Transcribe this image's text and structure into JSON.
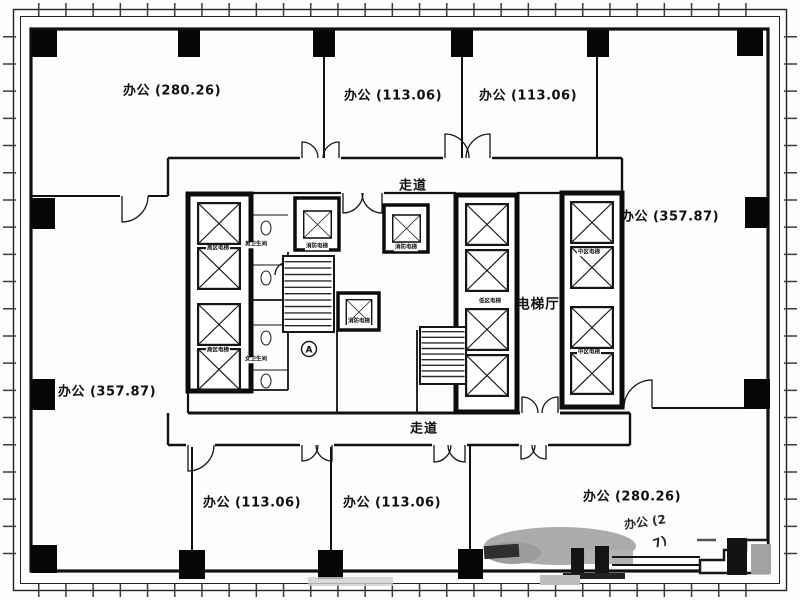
{
  "drawing": {
    "type": "architectural-floor-plan",
    "line_color": "#161616",
    "watermark_gray": "#a9a9a9"
  },
  "rooms": [
    {
      "id": "office-top-left",
      "text": "办公 (280.26)"
    },
    {
      "id": "office-top-mid-left",
      "text": "办公 (113.06)"
    },
    {
      "id": "office-top-mid-right",
      "text": "办公 (113.06)"
    },
    {
      "id": "office-right",
      "text": "办公 (357.87)"
    },
    {
      "id": "office-left",
      "text": "办公 (357.87)"
    },
    {
      "id": "office-bottom-left",
      "text": "办公 (113.06)"
    },
    {
      "id": "office-bottom-mid",
      "text": "办公 (113.06)"
    },
    {
      "id": "office-bottom-right",
      "text": "办公 (280.26)"
    },
    {
      "id": "office-partial-1",
      "text": "办公 (2"
    },
    {
      "id": "office-partial-2",
      "text": "7)"
    }
  ],
  "circulation": {
    "corridor_top": "走道",
    "corridor_bottom": "走道",
    "elevator_hall": "电梯厅"
  },
  "elevators": {
    "high_zone": "高区电梯",
    "low_zone": "低区电梯",
    "mid_zone": "中区电梯",
    "fire": "消防电梯"
  },
  "restrooms": {
    "men": "男卫生间",
    "women": "女卫生间"
  },
  "stair_marker": "A"
}
